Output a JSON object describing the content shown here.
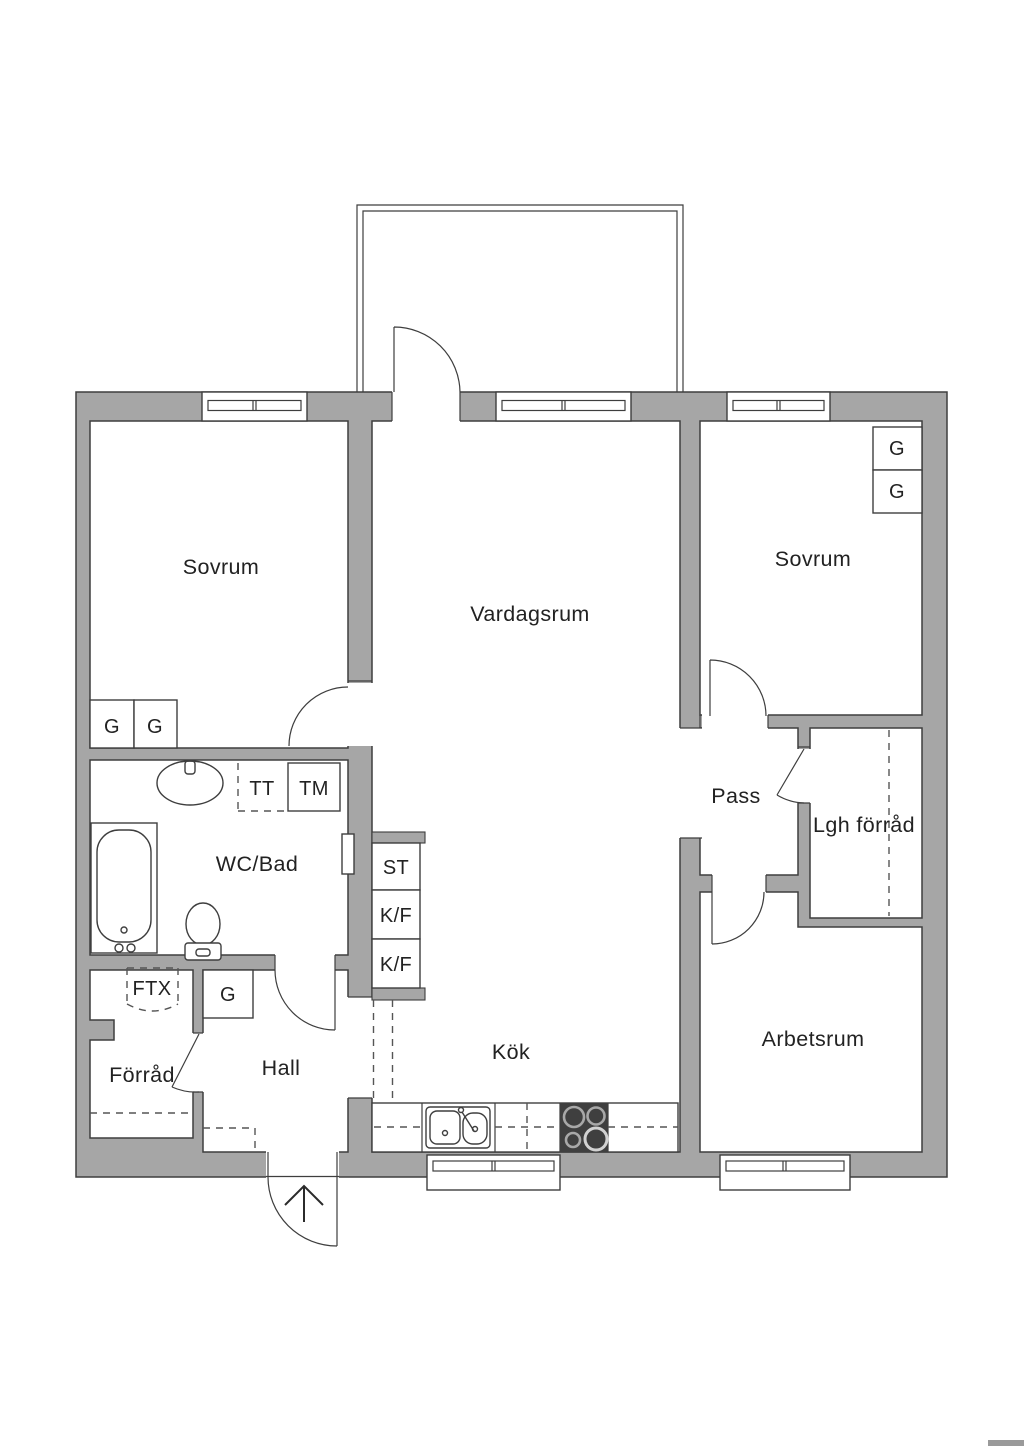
{
  "colors": {
    "wall": "#a6a6a6",
    "line": "#3e3e3e",
    "text": "#222222",
    "stove": "#3f3f3f",
    "watermark": "#9a9a9a"
  },
  "rooms": {
    "sovrum_left": "Sovrum",
    "vardagsrum": "Vardagsrum",
    "sovrum_right": "Sovrum",
    "wc_bad": "WC/Bad",
    "pass": "Pass",
    "lgh_forrad": "Lgh förråd",
    "arbetsrum": "Arbetsrum",
    "kok": "Kök",
    "hall": "Hall",
    "forrad": "Förråd"
  },
  "labels": {
    "wardrobe": "G",
    "towel_dryer": "TT",
    "washing_machine": "TM",
    "cleaning_closet": "ST",
    "fridge_freezer": "K/F",
    "ventilation": "FTX"
  }
}
